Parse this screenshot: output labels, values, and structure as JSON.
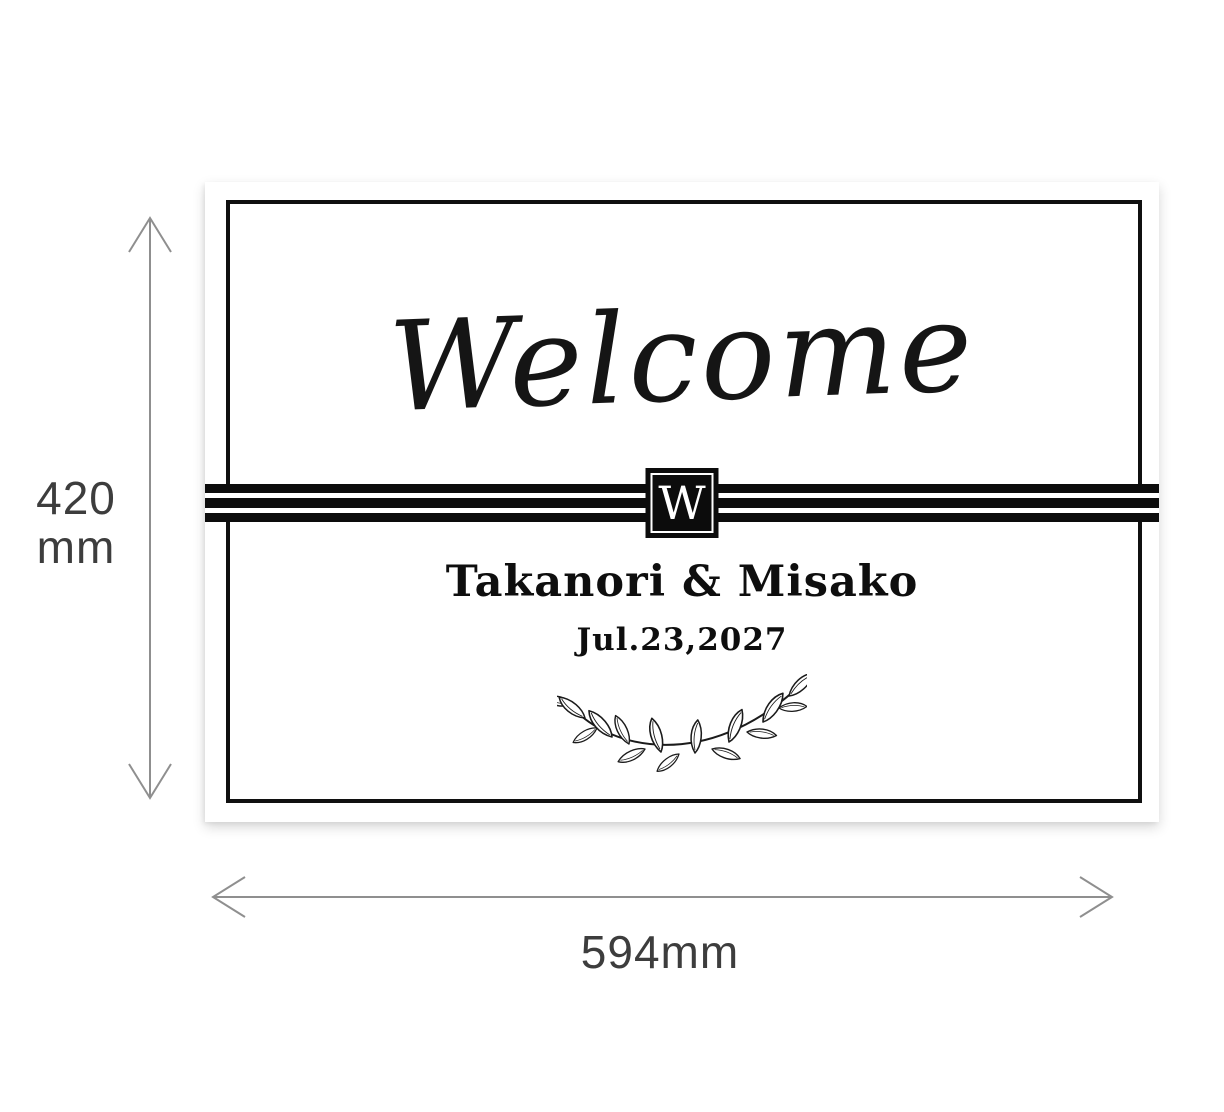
{
  "board": {
    "welcome": "Welcome",
    "monogram": "W",
    "names": "Takanori & Misako",
    "date": "Jul.23,2027",
    "decoration": "laurel-branch"
  },
  "dimensions": {
    "height": {
      "value": "420",
      "unit": "mm"
    },
    "width": {
      "label": "594mm"
    }
  },
  "colors": {
    "ink": "#101010",
    "board_background": "#ffffff",
    "page_background": "#ffffff",
    "dimension_arrow": "#8f8f8f",
    "dimension_text": "#3d3d3d",
    "monogram_background": "#0c0c0c",
    "monogram_letter": "#ffffff"
  }
}
